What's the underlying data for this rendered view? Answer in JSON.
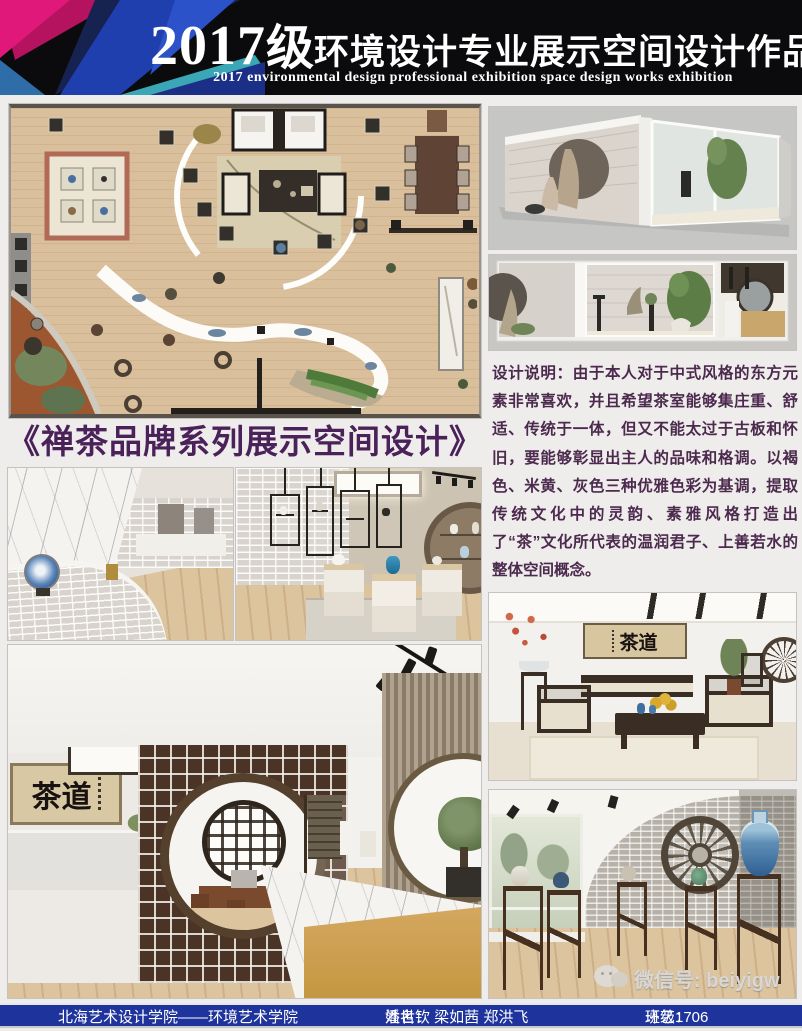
{
  "header": {
    "year": "2017",
    "grade": "级",
    "title_cn": "环境设计专业展示空间设计作品展",
    "subtitle_en": "2017 environmental design professional exhibition space design works exhibition"
  },
  "main": {
    "section_title": "《禅茶品牌系列展示空间设计》",
    "description_label": "设计说明：",
    "description_text": "由于本人对于中式风格的东方元素非常喜欢，并且希望茶室能够集庄重、舒适、传统于一体，但又不能太过于古板和怀旧，要能够彰显出主人的品味和格调。以褐色、米黄、灰色三种优雅色彩为基调，提取传统文化中的灵韵、素雅风格打造出了“茶”文化所代表的温润君子、上善若水的整体空间概念。",
    "calligraphy_text": "茶道"
  },
  "watermark": {
    "icon": "wechat-icon",
    "text": "微信号: beiyigw"
  },
  "footer": {
    "school": "北海艺术设计学院——环境艺术学院",
    "names_label": "姓名：",
    "names": "潘世钦 梁如茜 郑洪飞",
    "class_label": "班级：",
    "class_value": "环艺1706"
  },
  "colors": {
    "header_bg": "#0b0b0d",
    "footer_blue": "#1e339b",
    "title_purple": "#4a2158",
    "description_plum": "#4b2a4e",
    "deco_magenta": "#e0187a",
    "deco_blue": "#1f3fae",
    "deco_cyan": "#3fb7c9"
  }
}
